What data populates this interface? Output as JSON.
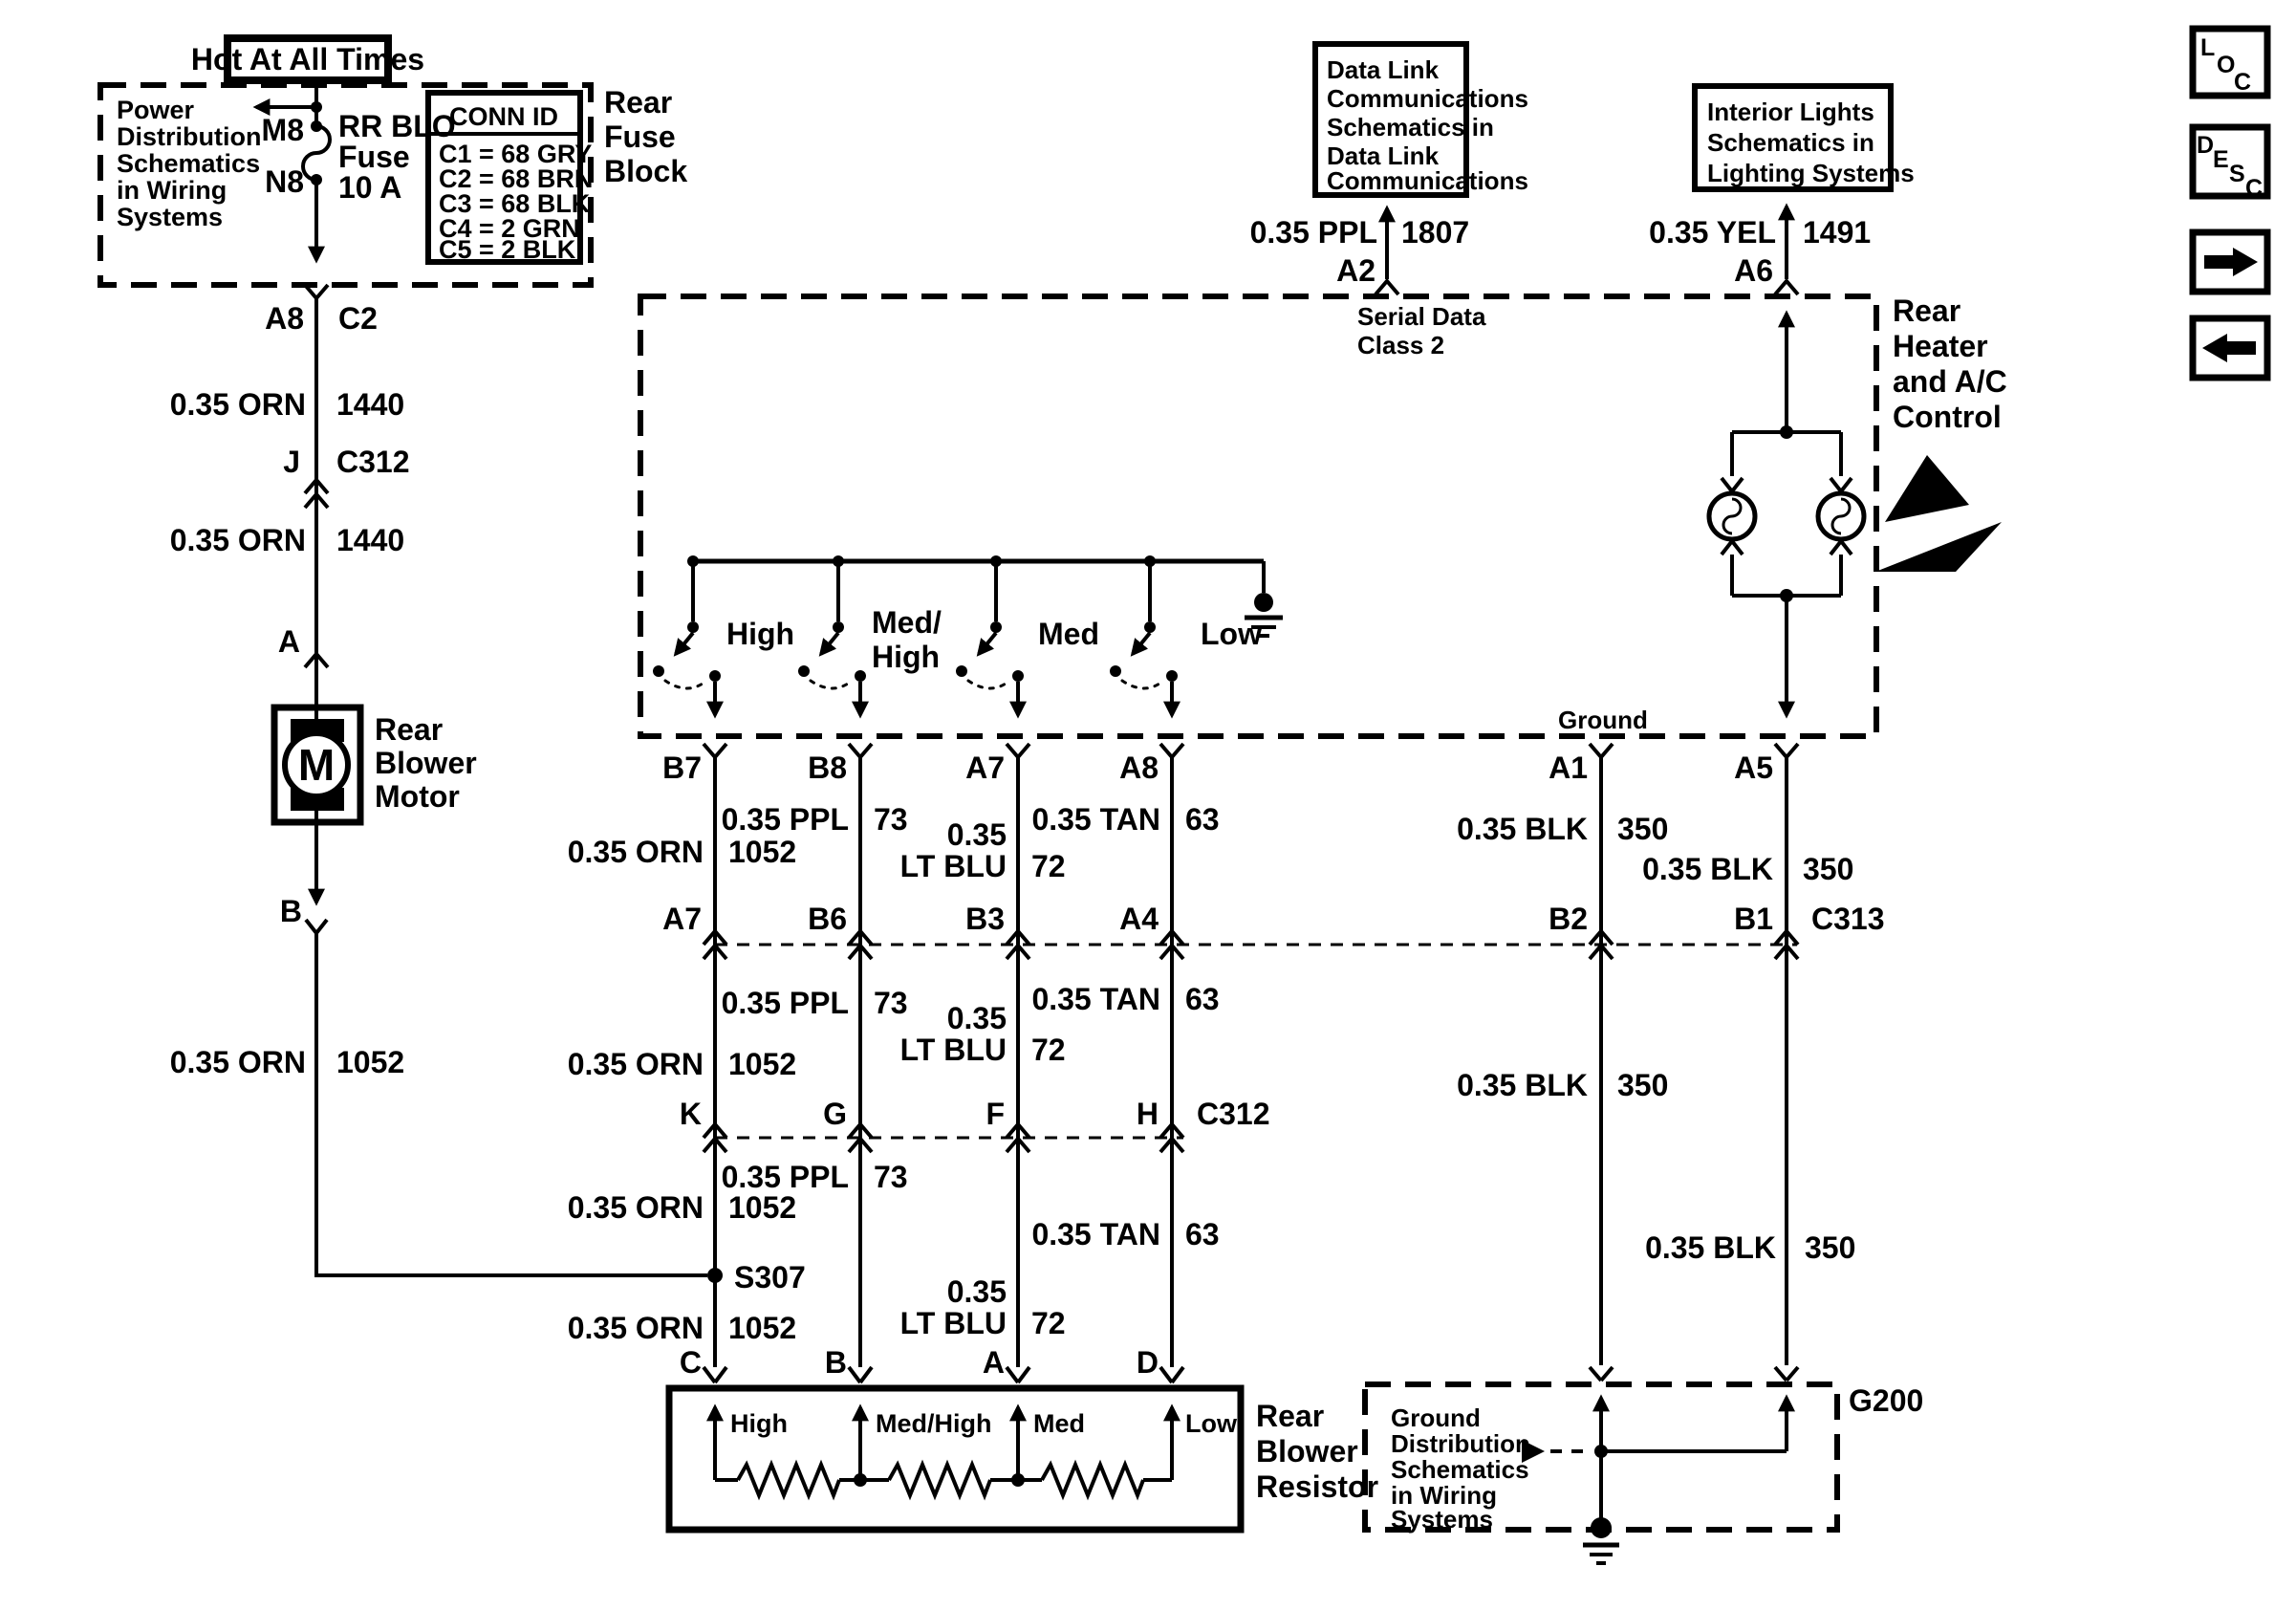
{
  "nav": {
    "loc": [
      "L",
      "O",
      "C"
    ],
    "desc": [
      "D",
      "E",
      "S",
      "C"
    ]
  },
  "fuse_feed": {
    "hot": "Hot At All Times",
    "note": [
      "Power",
      "Distribution",
      "Schematics",
      "in Wiring",
      "Systems"
    ],
    "pin_top": "M8",
    "pin_bottom": "N8",
    "fuse": [
      "RR BLO",
      "Fuse",
      "10 A"
    ],
    "block": [
      "Rear",
      "Fuse",
      "Block"
    ],
    "conn_id": {
      "title": "CONN ID",
      "rows": [
        "C1 = 68 GRY",
        "C2 = 68 BRN",
        "C3 = 68 BLK",
        "C4 = 2 GRN",
        "C5 = 2 BLK"
      ]
    }
  },
  "left": {
    "a8": "A8",
    "c2": "C2",
    "w1": {
      "l": "0.35 ORN",
      "n": "1440"
    },
    "j": "J",
    "c312": "C312",
    "w2": {
      "l": "0.35 ORN",
      "n": "1440"
    },
    "a": "A",
    "motor": {
      "letter": "M",
      "label": [
        "Rear",
        "Blower",
        "Motor"
      ]
    },
    "b": "B",
    "w3": {
      "l": "0.35 ORN",
      "n": "1052"
    }
  },
  "control": {
    "label": [
      "Rear",
      "Heater",
      "and A/C",
      "Control"
    ],
    "serial": {
      "pin": "A2",
      "w": {
        "l": "0.35 PPL",
        "n": "1807"
      },
      "note": [
        "Serial Data",
        "Class 2"
      ],
      "box": [
        "Data Link",
        "Communications",
        "Schematics in",
        "Data Link",
        "Communications"
      ]
    },
    "lights": {
      "pin": "A6",
      "w": {
        "l": "0.35 YEL",
        "n": "1491"
      },
      "box": [
        "Interior Lights",
        "Schematics in",
        "Lighting Systems"
      ]
    },
    "sw": {
      "s1": "High",
      "s2a": "Med/",
      "s2b": "High",
      "s3": "Med",
      "s4": "Low"
    },
    "ground": "Ground"
  },
  "pins": {
    "row1": {
      "p1": "B7",
      "p2": "B8",
      "p3": "A7",
      "p4": "A8",
      "p5": "A1",
      "p6": "A5"
    },
    "c313": {
      "p1": "A7",
      "p2": "B6",
      "p3": "B3",
      "p4": "A4",
      "p5": "B2",
      "p6": "B1",
      "name": "C313"
    },
    "c312": {
      "p1": "K",
      "p2": "G",
      "p3": "F",
      "p4": "H",
      "name": "C312"
    },
    "res": {
      "p1": "C",
      "p2": "B",
      "p3": "A",
      "p4": "D"
    }
  },
  "seg": {
    "c1s1": {
      "l": "0.35 ORN",
      "n": "1052"
    },
    "c1s2": {
      "l": "0.35 ORN",
      "n": "1052"
    },
    "c1s3a": {
      "l": "0.35 ORN",
      "n": "1052"
    },
    "c1s3b": {
      "l": "0.35 ORN",
      "n": "1052"
    },
    "c2s1": {
      "l": "0.35 PPL",
      "n": "73"
    },
    "c2s2": {
      "l": "0.35 PPL",
      "n": "73"
    },
    "c2s3": {
      "l": "0.35 PPL",
      "n": "73"
    },
    "c3s1": {
      "l1": "0.35",
      "l2": "LT BLU",
      "n": "72"
    },
    "c3s2": {
      "l1": "0.35",
      "l2": "LT BLU",
      "n": "72"
    },
    "c3s3": {
      "l1": "0.35",
      "l2": "LT BLU",
      "n": "72"
    },
    "c4s1": {
      "l": "0.35 TAN",
      "n": "63"
    },
    "c4s2": {
      "l": "0.35 TAN",
      "n": "63"
    },
    "c4s3": {
      "l": "0.35 TAN",
      "n": "63"
    },
    "c5s1": {
      "l": "0.35 BLK",
      "n": "350"
    },
    "c5s2": {
      "l": "0.35 BLK",
      "n": "350"
    },
    "c6s1": {
      "l": "0.35 BLK",
      "n": "350"
    },
    "c6s2": {
      "l": "0.35 BLK",
      "n": "350"
    }
  },
  "splice": "S307",
  "resistor": {
    "speeds": {
      "s1": "High",
      "s2": "Med/High",
      "s3": "Med",
      "s4": "Low"
    },
    "label": [
      "Rear",
      "Blower",
      "Resistor"
    ]
  },
  "g200": {
    "note": [
      "Ground",
      "Distribution",
      "Schematics",
      "in Wiring",
      "Systems"
    ],
    "name": "G200"
  }
}
